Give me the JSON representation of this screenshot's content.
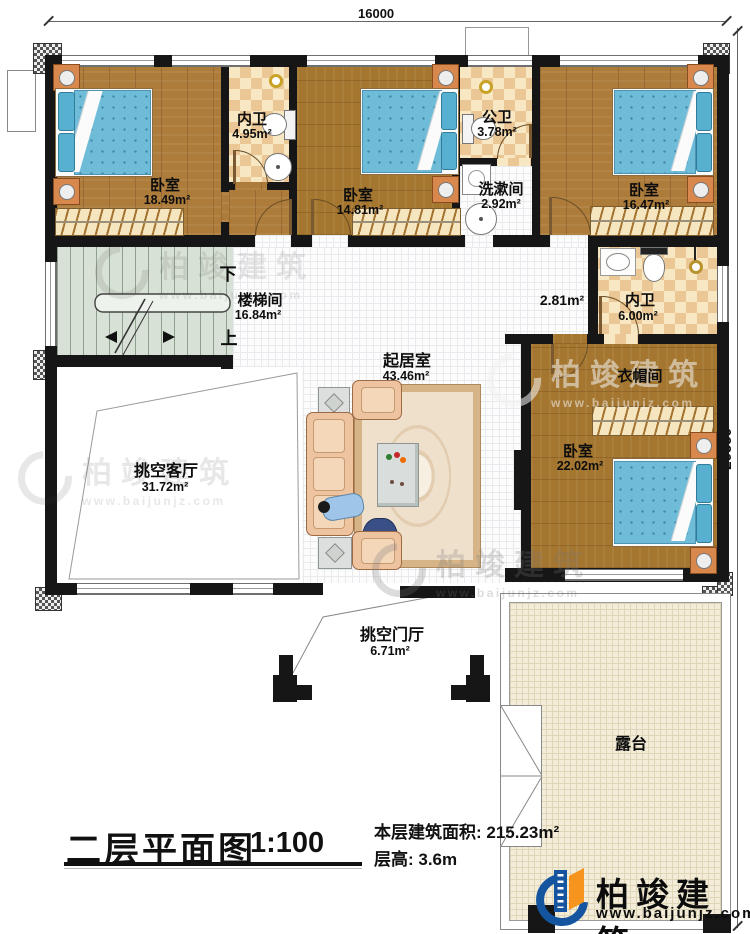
{
  "dimensions": {
    "top": "16000",
    "right": "20550"
  },
  "rooms": {
    "bedroom1": {
      "name": "卧室",
      "area": "18.49m²"
    },
    "bath1": {
      "name": "内卫",
      "area": "4.95m²"
    },
    "bedroom2": {
      "name": "卧室",
      "area": "14.81m²"
    },
    "public_bath": {
      "name": "公卫",
      "area": "3.78m²"
    },
    "washroom": {
      "name": "洗漱间",
      "area": "2.92m²"
    },
    "bedroom3": {
      "name": "卧室",
      "area": "16.47m²"
    },
    "stairwell": {
      "name": "楼梯间",
      "area": "16.84m²",
      "down": "下",
      "up": "上"
    },
    "corridor": {
      "area": "2.81m²"
    },
    "bath2": {
      "name": "内卫",
      "area": "6.00m²"
    },
    "living": {
      "name": "起居室",
      "area": "43.46m²"
    },
    "cloakroom": {
      "name": "衣帽间"
    },
    "bedroom4": {
      "name": "卧室",
      "area": "22.02m²"
    },
    "void_living": {
      "name": "挑空客厅",
      "area": "31.72m²"
    },
    "void_foyer": {
      "name": "挑空门厅",
      "area": "6.71m²"
    },
    "terrace": {
      "name": "露台"
    }
  },
  "title": {
    "text": "二层平面图",
    "scale": "1:100"
  },
  "info": {
    "area": "本层建筑面积: 215.23m²",
    "floor_height": "层高: 3.6m"
  },
  "brand": {
    "name": "柏竣建筑",
    "url": "www.baijunjz.com"
  },
  "watermark": {
    "name": "柏竣建筑",
    "url": "www.baijunjz.com"
  }
}
